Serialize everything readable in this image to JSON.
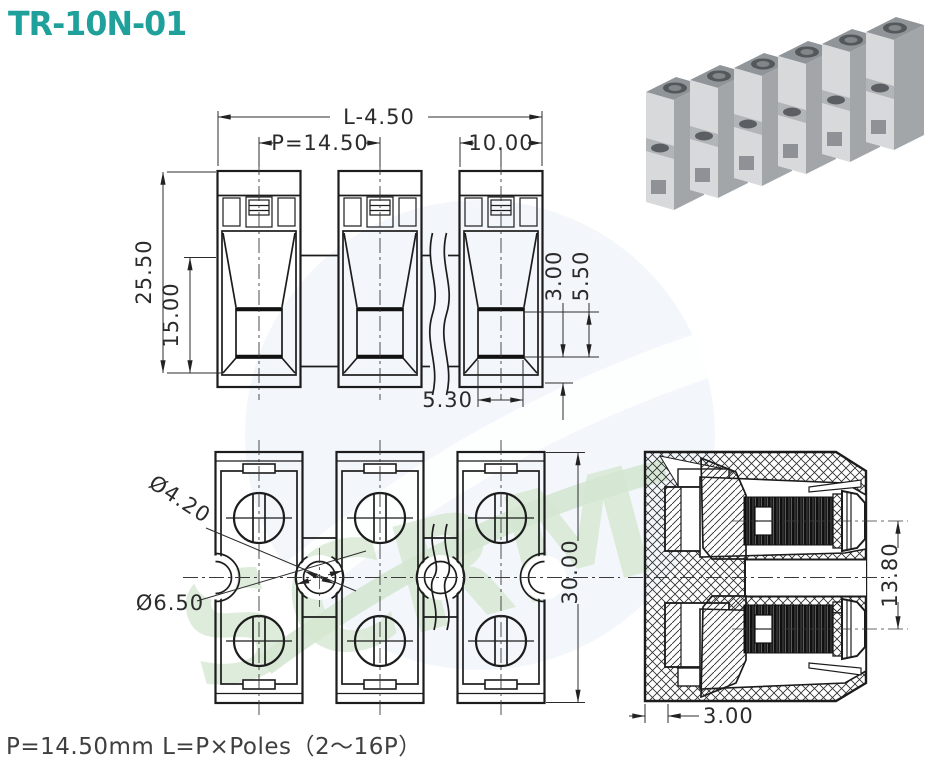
{
  "title": "TR-10N-01",
  "footer": {
    "formula": "P=14.50mm  L=P×Poles（2～16P）"
  },
  "watermark": {
    "text": "SCRM"
  },
  "colors": {
    "title_teal": "#1fa09b",
    "drawing_line": "#1c1c1c",
    "watermark_blue": "#e2eaf5",
    "watermark_green": "#c9dfc4"
  },
  "photo": {
    "blocks_visible": 6
  },
  "front_view": {
    "dims": {
      "overall_length": "L-4.50",
      "pitch": "P=14.50",
      "block_width": "10.00",
      "total_height": "25.50",
      "cavity_height": "15.00",
      "base_height": "3.00",
      "opening_height": "5.50",
      "opening_width": "5.30"
    }
  },
  "bottom_view": {
    "dims": {
      "mount_hole_dia": "Ø4.20",
      "recess_dia": "Ø6.50",
      "depth": "30.00"
    }
  },
  "section_view": {
    "dims": {
      "screw_center_height": "13.80",
      "wall_thickness": "3.00"
    }
  }
}
